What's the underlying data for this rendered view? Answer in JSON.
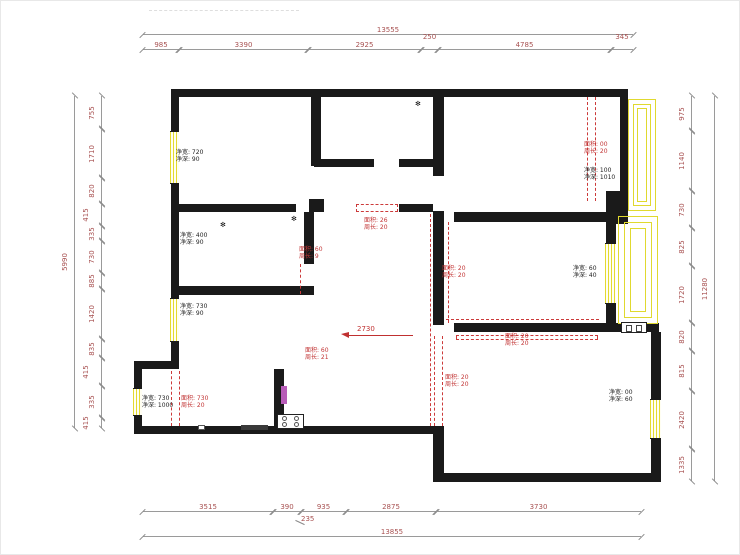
{
  "drawing": {
    "kind_label": "residential floor plan",
    "arrow_note": "2730"
  },
  "colors": {
    "wall": "#1a1a1a",
    "window": "#e3da2e",
    "annotation_red": "#c23434",
    "dimension_text": "#a85252"
  },
  "dims": {
    "top": {
      "total": "13555",
      "segments": [
        "985",
        "3390",
        "2925",
        "250",
        "4785",
        "345"
      ]
    },
    "bottom": {
      "total": "13855",
      "segments": [
        "3515",
        "390",
        "935",
        "2875",
        "3730"
      ],
      "offset_label": "235"
    },
    "left": {
      "total": "5990",
      "segments": [
        "755",
        "1710",
        "820",
        "415",
        "335",
        "730",
        "885",
        "1420",
        "835",
        "415",
        "335",
        "415"
      ]
    },
    "right": {
      "total": "11280",
      "segments": [
        "975",
        "1140",
        "730",
        "825",
        "1720",
        "820",
        "815",
        "2420",
        "1335"
      ]
    }
  },
  "rooms": [
    {
      "line1": "净宽: 720",
      "line2": "净深: 90"
    },
    {
      "line1": "净宽: 400",
      "line2": "净深: 90"
    },
    {
      "line1": "净宽: 730",
      "line2": "净深: 90"
    },
    {
      "line1": "净宽: 730",
      "line2": "净深: 1000"
    },
    {
      "line1": "净宽: 100",
      "line2": "净深: 1010"
    },
    {
      "line1": "净宽: 60",
      "line2": "净深: 40"
    },
    {
      "line1": "净宽: 00",
      "line2": "净深: 60"
    }
  ],
  "annotations": [
    {
      "line1": "面积: 00",
      "line2": "周长: 20"
    },
    {
      "line1": "面积: 26",
      "line2": "周长: 20"
    },
    {
      "line1": "面积: 60",
      "line2": "周长: 9"
    },
    {
      "line1": "面积: 20",
      "line2": "周长: 20"
    },
    {
      "line1": "面积: 20",
      "line2": "周长: 20"
    },
    {
      "line1": "面积: 20",
      "line2": "周长: 20"
    },
    {
      "line1": "面积: 60",
      "line2": "周长: 21"
    },
    {
      "line1": "面积: 730",
      "line2": "周长: 20"
    }
  ]
}
